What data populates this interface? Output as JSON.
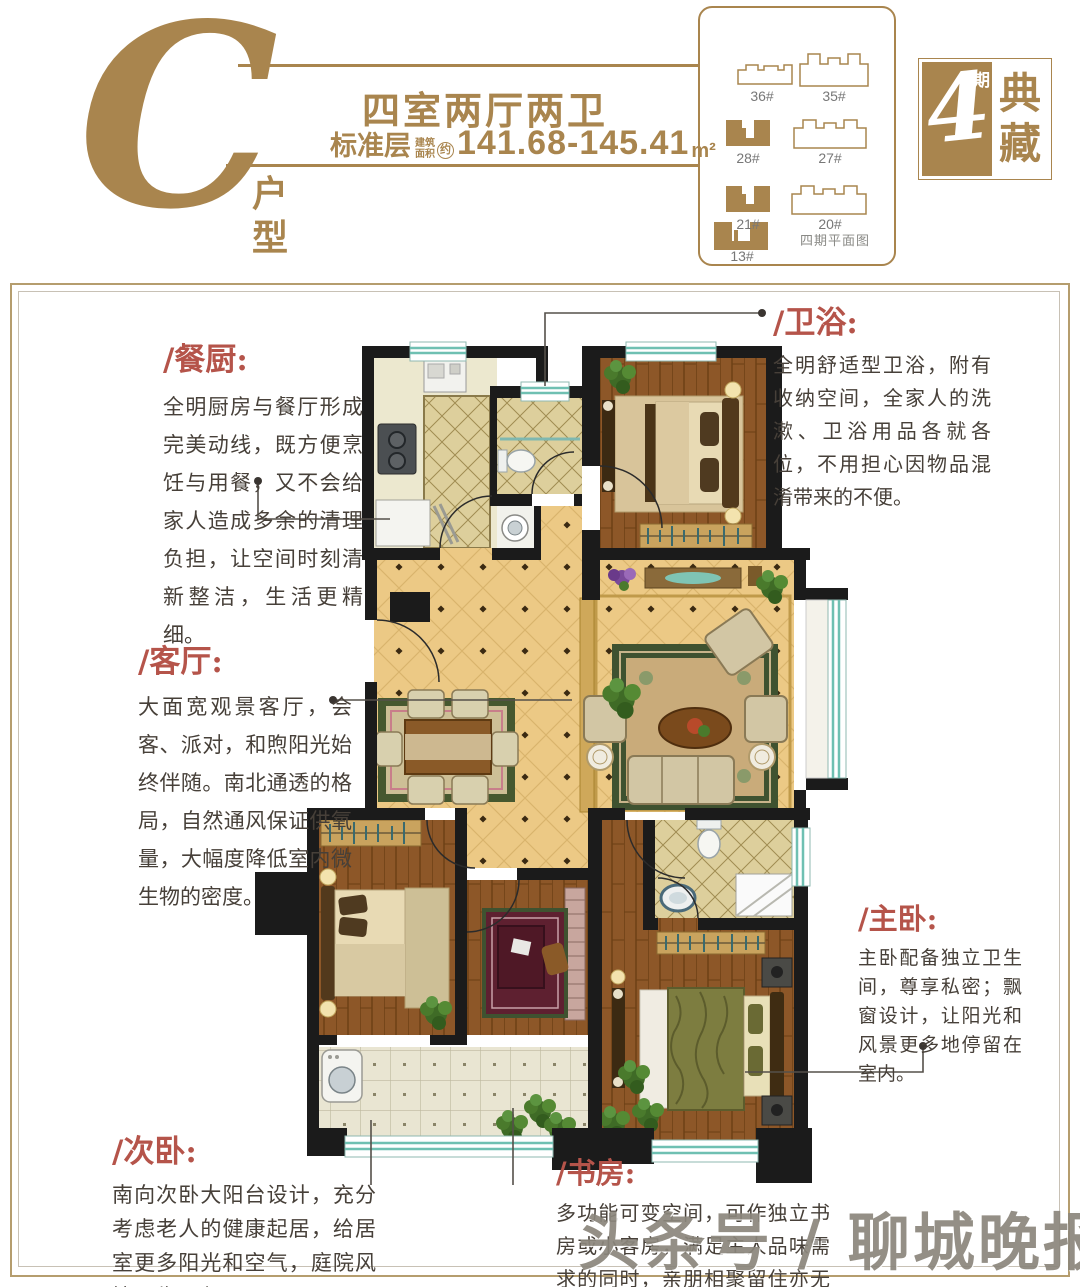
{
  "header": {
    "letter": "C",
    "letter_label_1": "户",
    "letter_label_2": "型",
    "title": "四室两厅两卫",
    "subtitle_prefix": "标准层",
    "subtitle_small_1": "建筑",
    "subtitle_small_2": "面积",
    "subtitle_approx": "约",
    "area_value": "141.68-145.41",
    "area_unit": "m²"
  },
  "site_panel": {
    "caption": "四期平面图",
    "buildings": [
      {
        "label": "36#",
        "filled": false
      },
      {
        "label": "35#",
        "filled": false
      },
      {
        "label": "28#",
        "filled": true
      },
      {
        "label": "27#",
        "filled": false
      },
      {
        "label": "21#",
        "filled": true
      },
      {
        "label": "20#",
        "filled": false
      },
      {
        "label": "13#",
        "filled": true
      }
    ]
  },
  "badge": {
    "number": "4",
    "number_suffix": "期",
    "name_top": "典",
    "name_bottom": "藏"
  },
  "annotations": {
    "canchu": {
      "heading": "/餐厨:",
      "body": "全明厨房与餐厅形成完美动线，既方便烹饪与用餐，又不会给家人造成多余的清理负担，让空间时刻清新整洁，生活更精细。"
    },
    "weiyu": {
      "heading": "/卫浴:",
      "body": "全明舒适型卫浴，附有收纳空间，全家人的洗漱、卫浴用品各就各位，不用担心因物品混淆带来的不便。"
    },
    "keting": {
      "heading": "/客厅:",
      "body": "大面宽观景客厅，会客、派对，和煦阳光始终伴随。南北通透的格局，自然通风保证供氧量，大幅度降低室内微生物的密度。"
    },
    "zhuwo": {
      "heading": "/主卧:",
      "body": "主卧配备独立卫生间，尊享私密；飘窗设计，让阳光和风景更多地停留在室内。"
    },
    "ciwo": {
      "heading": "/次卧:",
      "body": "南向次卧大阳台设计，充分考虑老人的健康起居，给居室更多阳光和空气，庭院风情尽收眼底。"
    },
    "shufang": {
      "heading": "/书房:",
      "body": "多功能可变空间，可作独立书房或小客房，满足主人品味需求的同时，亲朋相聚留住亦无忧。"
    }
  },
  "watermark": "头条号 / 聊城晚报",
  "colors": {
    "accent_gold": "#a9854e",
    "heading_red": "#b5544a",
    "wall_black": "#1b1b1b",
    "window_teal": "#6fc0b2",
    "body_text": "#474039"
  }
}
